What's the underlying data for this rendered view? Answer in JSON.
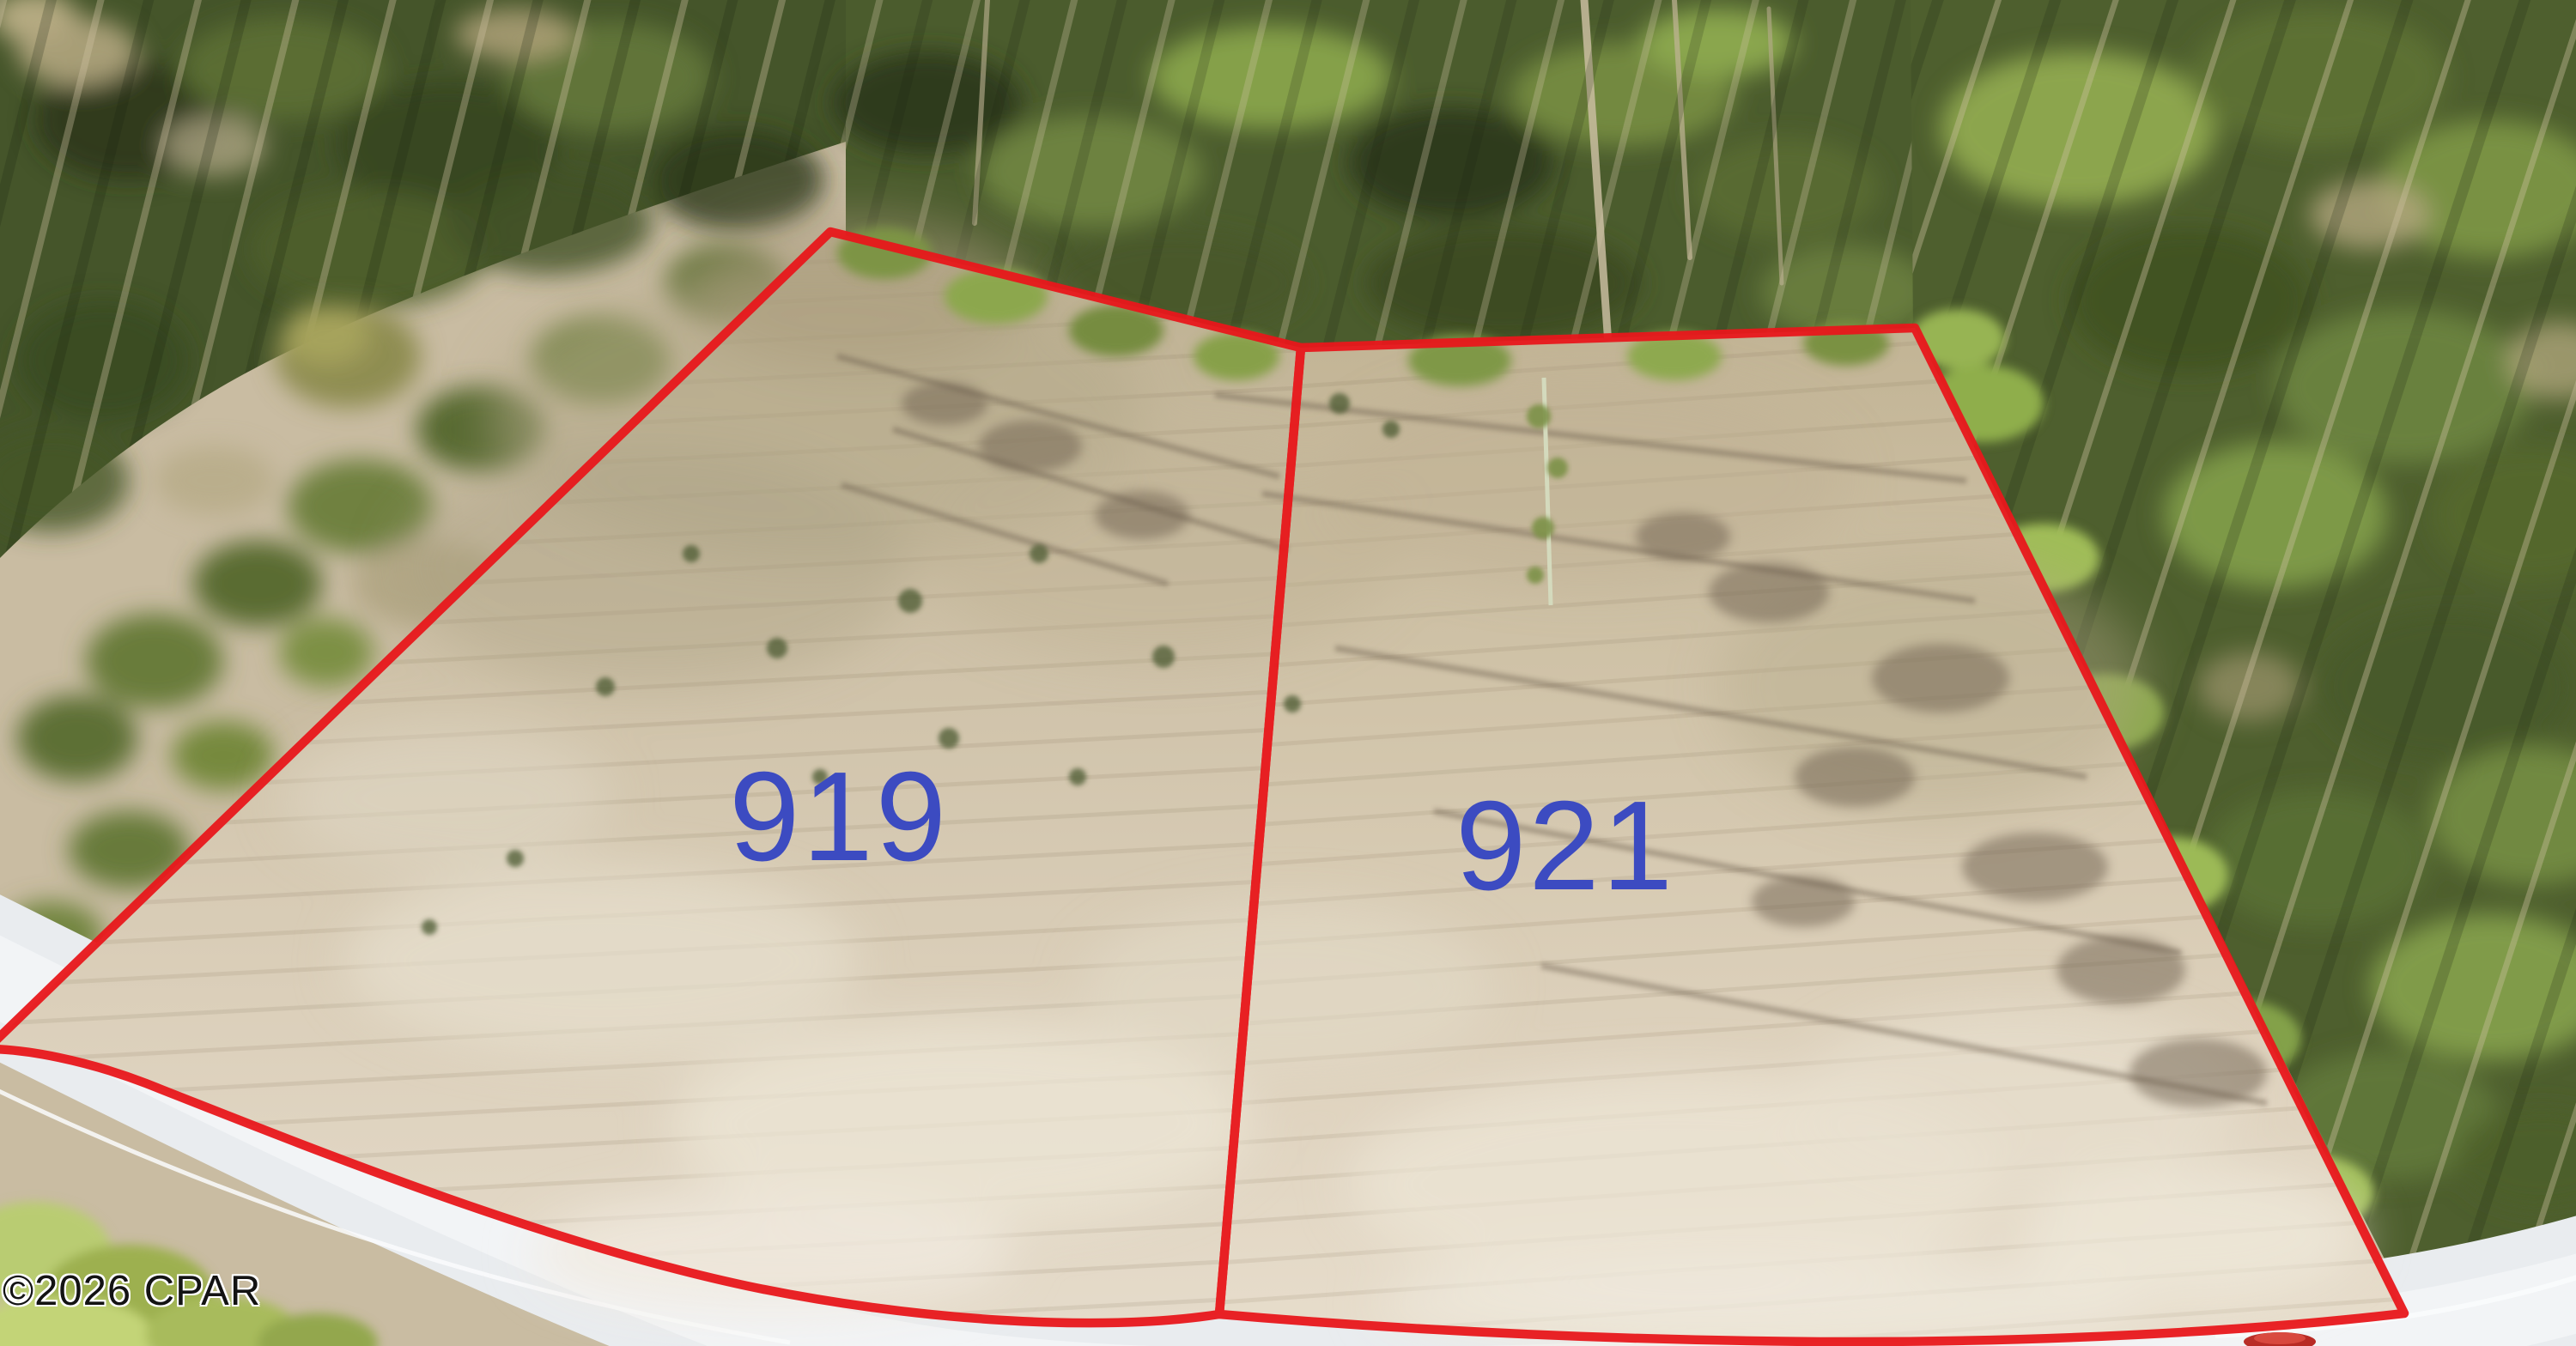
{
  "photo": {
    "kind": "aerial-drone-photo",
    "lot_numbers_visible": [
      "919",
      "921"
    ]
  },
  "lots": [
    {
      "name": "lot-919",
      "number": "919",
      "number_color": "#3c4bc1",
      "boundary_color": "#e8171b",
      "boundary_path": "M 967 270 L 1515 405 L 1420 1531 C 1280 1553 1060 1538 870 1498 C 640 1449 380 1345 170 1262 C 100 1235 30 1222 -15 1222 Z"
    },
    {
      "name": "lot-921",
      "number": "921",
      "number_color": "#3c4bc1",
      "boundary_color": "#e8171b",
      "boundary_path": "M 1515 405 L 2230 382 L 2800 1530 C 2620 1551 2380 1564 2120 1563 C 1870 1561 1640 1550 1420 1531 Z"
    }
  ],
  "watermark": {
    "text": "©2026 CPAR",
    "text_color": "#131313",
    "outline_color": "#ffffff"
  },
  "scene_colors": {
    "boundary_red": "#e8171b",
    "label_blue": "#3c4bc1",
    "cleared_dirt": "#d3c6ae",
    "forest_green": "#4b5c2d",
    "road_gray": "#e9ecef"
  }
}
